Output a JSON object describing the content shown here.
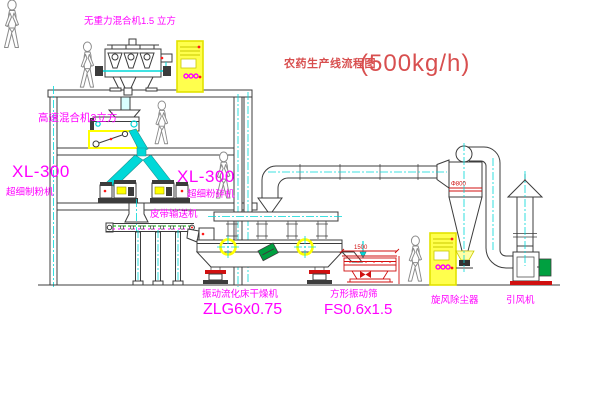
{
  "title": {
    "text": "农药生产线流程图",
    "capacity": "(500kg/h)"
  },
  "labels": {
    "gravity_mixer": "无重力混合机1.5 立方",
    "high_speed_mixer": "高速混合机3立方",
    "mill_left": {
      "model": "XL-300",
      "name": "超细制粉机"
    },
    "mill_right": {
      "model": "XL-300",
      "name": "超细粉碎机"
    },
    "belt_conveyor": "皮带输送机",
    "dryer": {
      "name": "振动流化床干燥机",
      "model": "ZLG6x0.75"
    },
    "screen": {
      "name": "方形振动筛",
      "model": "FS0.6x1.5"
    },
    "cyclone": "旋风除尘器",
    "fan": "引风机"
  },
  "dimensions": {
    "screen_length": "1500",
    "cyclone_diameter": "Φ800"
  },
  "colors": {
    "line": "#3c3c3c",
    "cyan": "#00d8d8",
    "magenta": "#ff00ff",
    "yellow": "#ffff00",
    "red": "#d01010",
    "green": "#00a040",
    "gray": "#8a8a8a",
    "titleRed": "#d84f4f"
  }
}
